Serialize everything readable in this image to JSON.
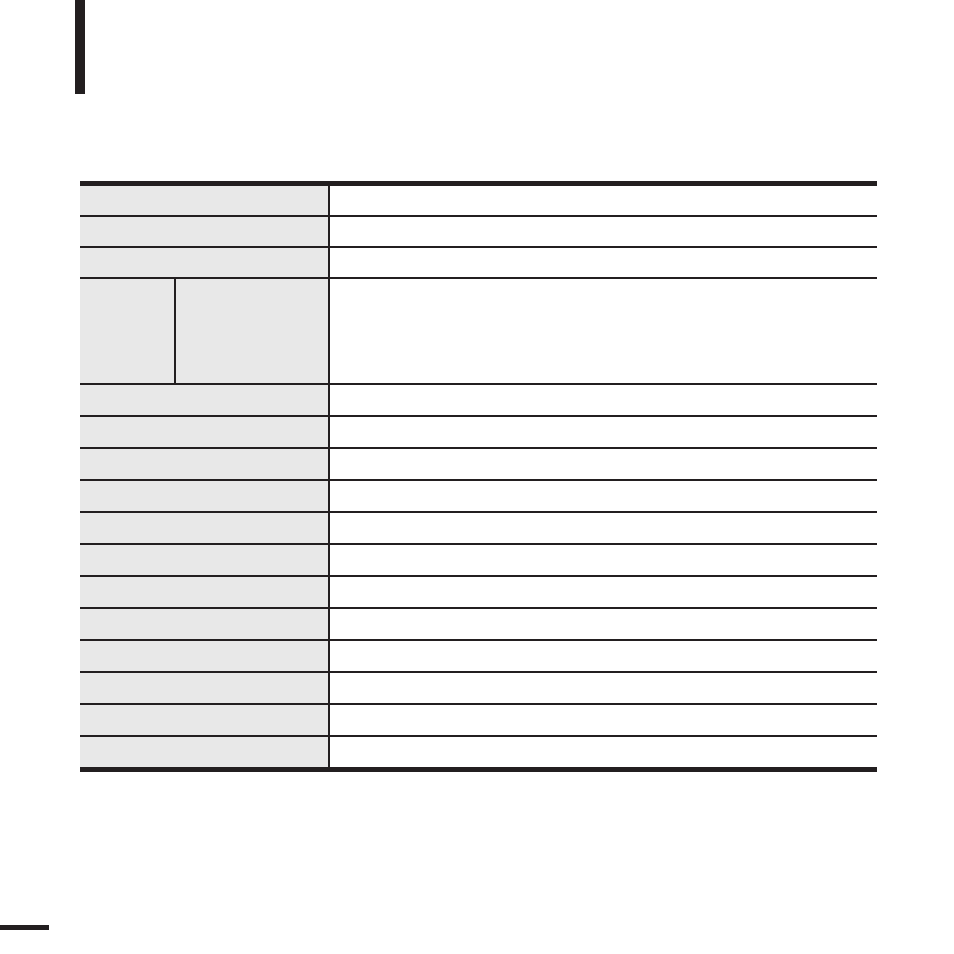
{
  "page": {
    "background_color": "#ffffff",
    "chapter_tab_color": "#231f20",
    "footer_tab_color": "#231f20"
  },
  "spec_table": {
    "line_color": "#231f20",
    "label_column_bg": "#e8e8e8",
    "value_column_bg": "#ffffff",
    "rows": [
      {
        "type": "simple",
        "label": "",
        "value": ""
      },
      {
        "type": "simple",
        "label": "",
        "value": ""
      },
      {
        "type": "simple",
        "label": "",
        "value": ""
      },
      {
        "type": "split",
        "label_left": "",
        "label_right": "",
        "value": ""
      },
      {
        "type": "simple",
        "label": "",
        "value": ""
      },
      {
        "type": "simple",
        "label": "",
        "value": ""
      },
      {
        "type": "simple",
        "label": "",
        "value": ""
      },
      {
        "type": "simple",
        "label": "",
        "value": ""
      },
      {
        "type": "simple",
        "label": "",
        "value": ""
      },
      {
        "type": "simple",
        "label": "",
        "value": ""
      },
      {
        "type": "simple",
        "label": "",
        "value": ""
      },
      {
        "type": "simple",
        "label": "",
        "value": ""
      },
      {
        "type": "simple",
        "label": "",
        "value": ""
      },
      {
        "type": "simple",
        "label": "",
        "value": ""
      },
      {
        "type": "simple",
        "label": "",
        "value": ""
      },
      {
        "type": "simple",
        "label": "",
        "value": ""
      }
    ]
  }
}
